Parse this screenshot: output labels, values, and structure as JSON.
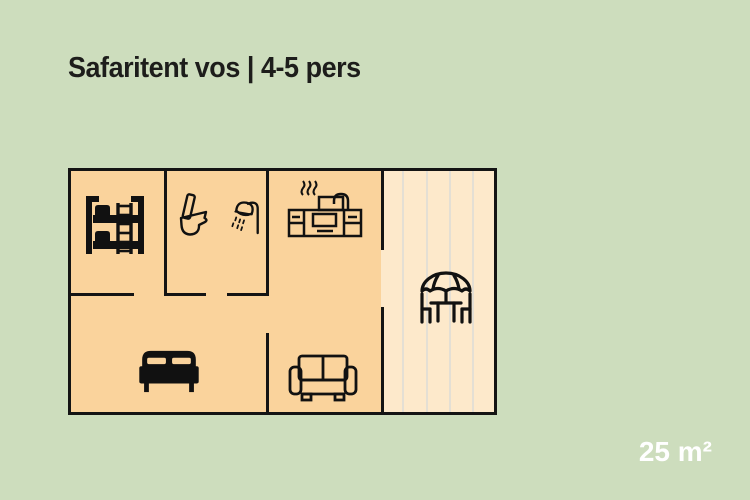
{
  "title": "Safaritent vos | 4-5 pers",
  "area_label": "25 m²",
  "colors": {
    "background": "#cdddbd",
    "floor": "#fad39c",
    "veranda_floor": "#fde9cb",
    "plank_line": "#e4dfd4",
    "wall": "#141414",
    "icon": "#111111",
    "title_text": "#1d1d1b",
    "area_text": "#ffffff"
  },
  "floorplan": {
    "icons": [
      "bunk-bed-icon",
      "toilet-icon",
      "shower-icon",
      "kitchen-icon",
      "double-bed-icon",
      "sofa-icon",
      "patio-set-icon"
    ]
  }
}
